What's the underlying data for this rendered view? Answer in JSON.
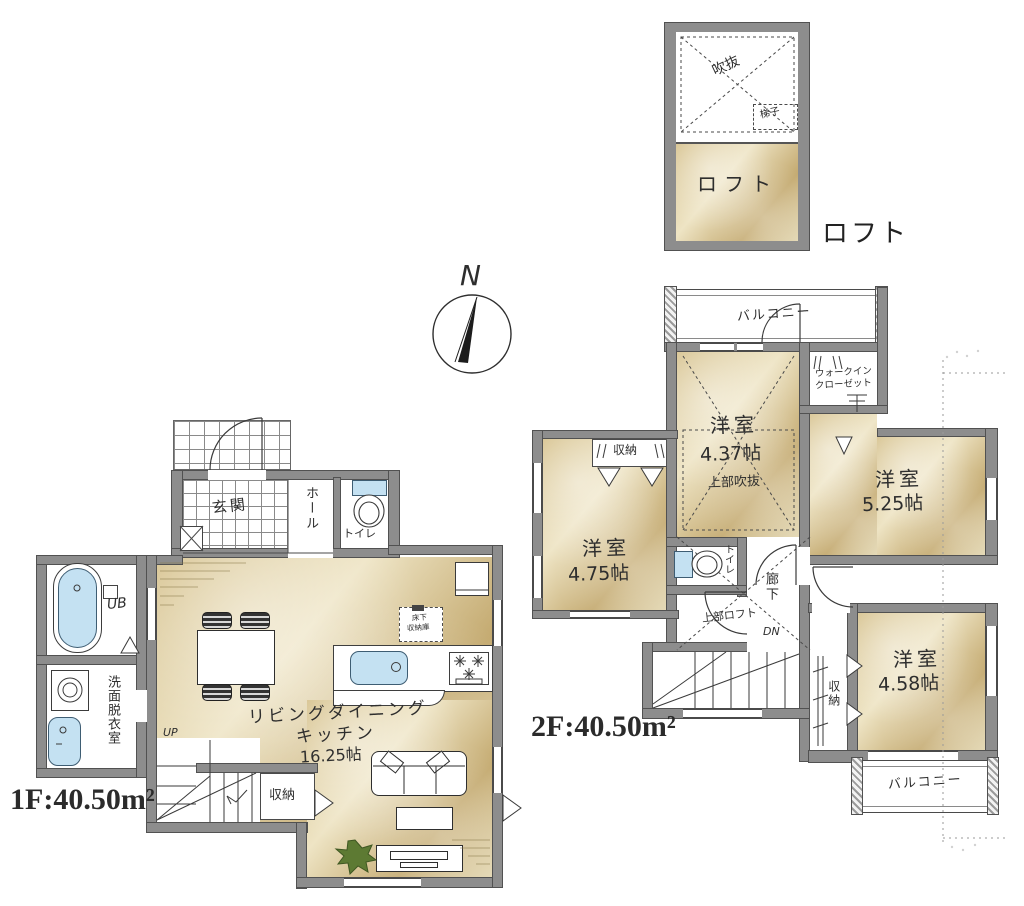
{
  "compass": {
    "north_label": "N"
  },
  "loft": {
    "caption": "ロフト",
    "void_label": "吹抜",
    "ladder_label": "梯子",
    "room_label": "ロフト"
  },
  "floor2": {
    "area_label": "2F:40.50m²",
    "balcony_top": "バルコニー",
    "balcony_bottom": "バルコニー",
    "closet_left": "収納",
    "closet_bottom": "収納",
    "wic_line1": "ウォークイン",
    "wic_line2": "クローゼット",
    "room_center": {
      "name": "洋室",
      "size": "4.37帖",
      "note": "上部吹抜"
    },
    "room_right": {
      "name": "洋室",
      "size": "5.25帖"
    },
    "room_left": {
      "name": "洋室",
      "size": "4.75帖"
    },
    "room_bottom": {
      "name": "洋室",
      "size": "4.58帖"
    },
    "toilet": "トイレ",
    "hallway": "廊下",
    "loft_above": "上部ロフト",
    "down_label": "DN"
  },
  "floor1": {
    "area_label": "1F:40.50m²",
    "entrance": "玄関",
    "hall": "ホール",
    "toilet": "トイレ",
    "bath": "UB",
    "washroom": "洗面脱衣室",
    "ldk_line1": "リビングダイニング",
    "ldk_line2": "キッチン",
    "ldk_size": "16.25帖",
    "up_label": "UP",
    "closet": "収納",
    "underfloor_line1": "床下",
    "underfloor_line2": "収納庫"
  }
}
